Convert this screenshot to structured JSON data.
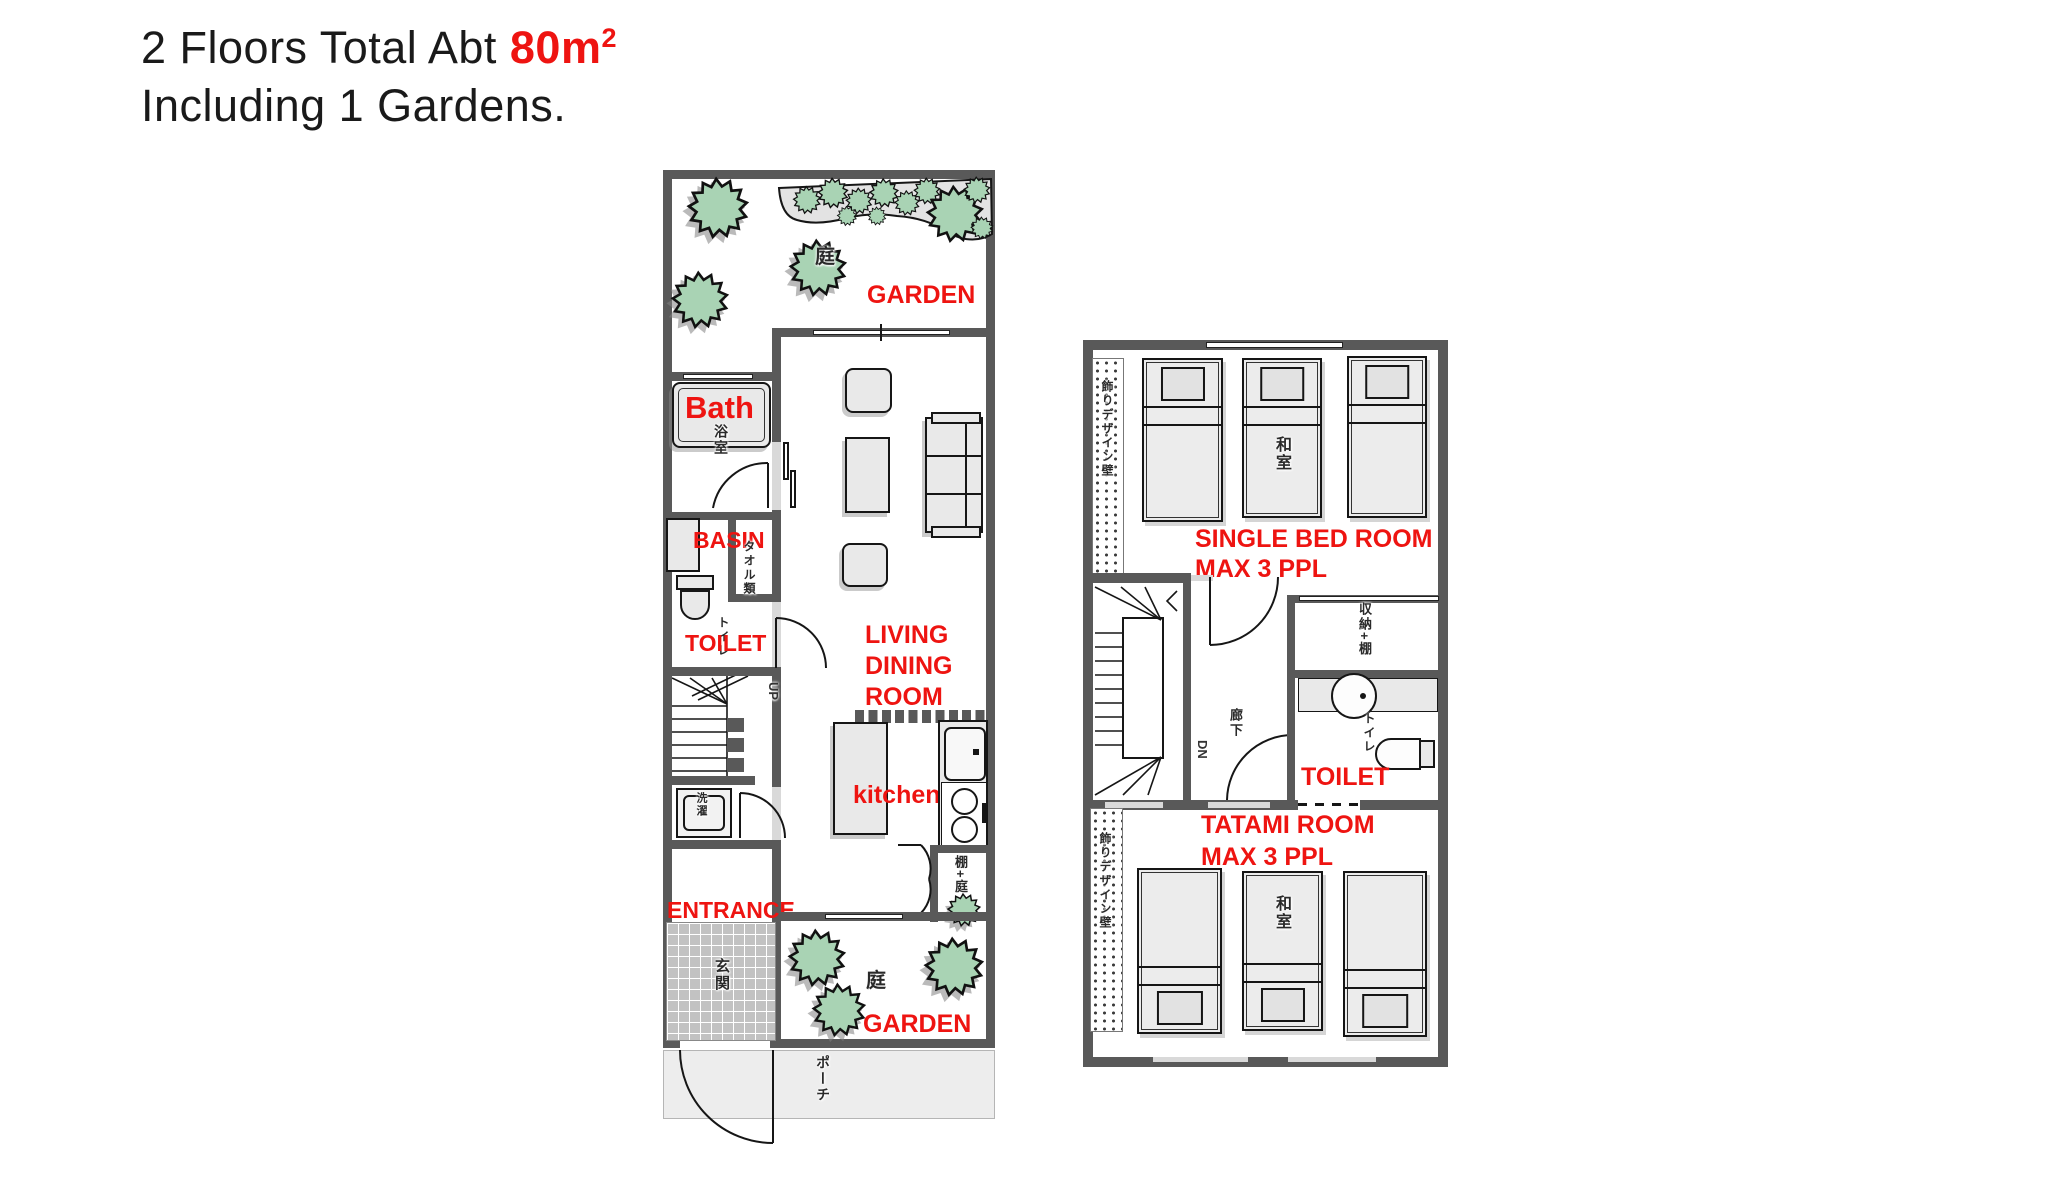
{
  "title": {
    "line1_black": "2 Floors Total Abt",
    "area_red": "80m",
    "area_exp": "2",
    "line2": "Including 1 Gardens."
  },
  "colors": {
    "label_red": "#ee1411",
    "wall_gray": "#595959",
    "bush_green": "#a9d3b4",
    "furniture_fill": "#e9e9e9",
    "porch_gray": "#ededed",
    "tile_gray": "#c2c2c2"
  },
  "floor1": {
    "garden_top": {
      "label": "GARDEN",
      "tree_kanji": "庭"
    },
    "bath": {
      "label": "Bath",
      "kanji": "浴室"
    },
    "basin": {
      "label": "BASIN",
      "shelf_kanji": "タオル類"
    },
    "toilet": {
      "label": "TOILET",
      "kanji": "トイレ"
    },
    "living_dining": {
      "line1": "LIVING",
      "line2": "DINING",
      "line3": "ROOM"
    },
    "stairs_label": "UP",
    "laundry_kanji": "洗濯",
    "kitchen": {
      "label": "kitchen"
    },
    "closet_kanji": "棚+庭",
    "entrance": {
      "label": "ENTRANCE",
      "kanji": "玄関"
    },
    "garden_bottom": {
      "label": "GARDEN",
      "tree_kanji": "庭"
    },
    "porch_kanji": "ポーチ"
  },
  "floor2": {
    "single_bed_room": {
      "line1": "SINGLE BED ROOM",
      "line2": "MAX 3 PPL",
      "bed_kanji": "和室"
    },
    "deco_wall_kanji_top": "飾りデザイン壁",
    "deco_wall_kanji_bottom": "飾りデザイン壁",
    "stairs_label": "DN",
    "hallway_kanji": "廊下",
    "storage_kanji": "収納+棚",
    "toilet": {
      "label": "TOILET",
      "kanji": "トイレ"
    },
    "tatami_room": {
      "line1": "TATAMI ROOM",
      "line2": "MAX 3 PPL",
      "bed_kanji": "和室"
    }
  }
}
